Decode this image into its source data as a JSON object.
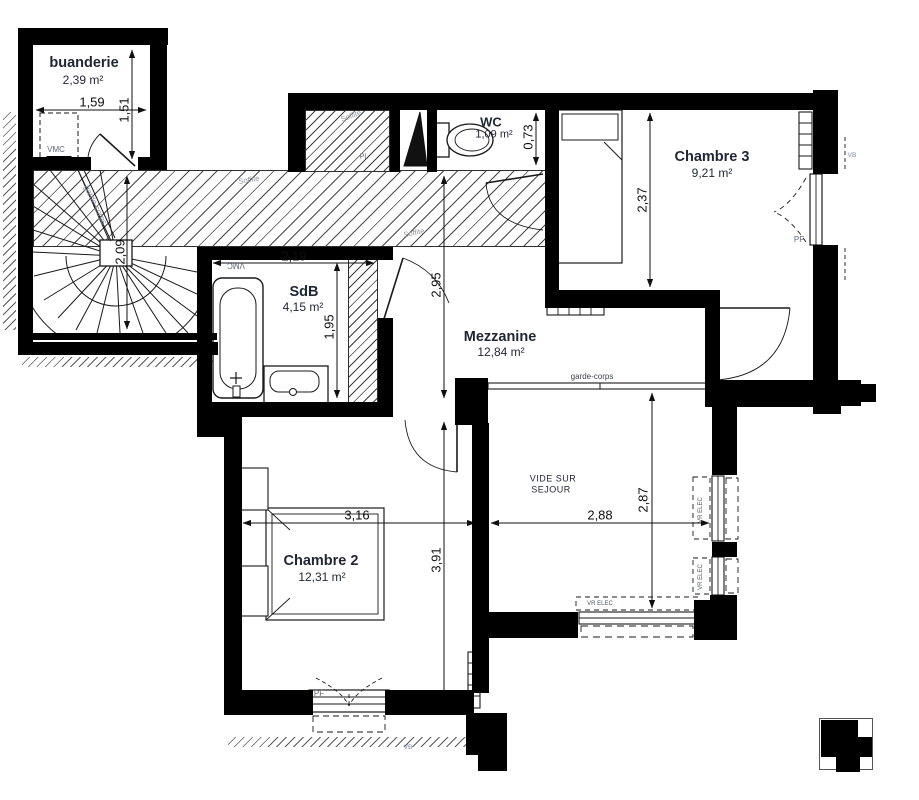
{
  "rooms": {
    "buanderie": {
      "name": "buanderie",
      "area": "2,39 m²"
    },
    "wc": {
      "name": "WC",
      "area": "1,09 m²"
    },
    "chambre3": {
      "name": "Chambre 3",
      "area": "9,21 m²"
    },
    "sdb": {
      "name": "SdB",
      "area": "4,15 m²"
    },
    "mezzanine": {
      "name": "Mezzanine",
      "area": "12,84 m²"
    },
    "chambre2": {
      "name": "Chambre 2",
      "area": "12,31 m²"
    },
    "vide": {
      "line1": "VIDE SUR",
      "line2": "SEJOUR"
    }
  },
  "dimensions": {
    "buanderie_width": "1,59",
    "buanderie_height": "1,51",
    "stairs_height": "2,09",
    "sdb_width": "2,19",
    "sdb_height": "1,95",
    "mezzanine_height": "2,95",
    "wc_depth": "0,73",
    "chambre3_height": "2,37",
    "chambre2_width": "3,16",
    "vide_width": "2,88",
    "chambre2_height": "3,91",
    "vide_height": "2,87"
  },
  "annotations": {
    "vmc": "VMC",
    "soffite": "Soffite",
    "pl": "PL",
    "garde_corps": "garde-corps",
    "pf": "PF",
    "vb": "VB",
    "vr_elec": "VR ELEC"
  },
  "colors": {
    "wall": "#000000",
    "line": "#1a1a1a",
    "room_text": "#1f2533",
    "tech_text": "#5c6676",
    "dim_text": "#101010"
  }
}
